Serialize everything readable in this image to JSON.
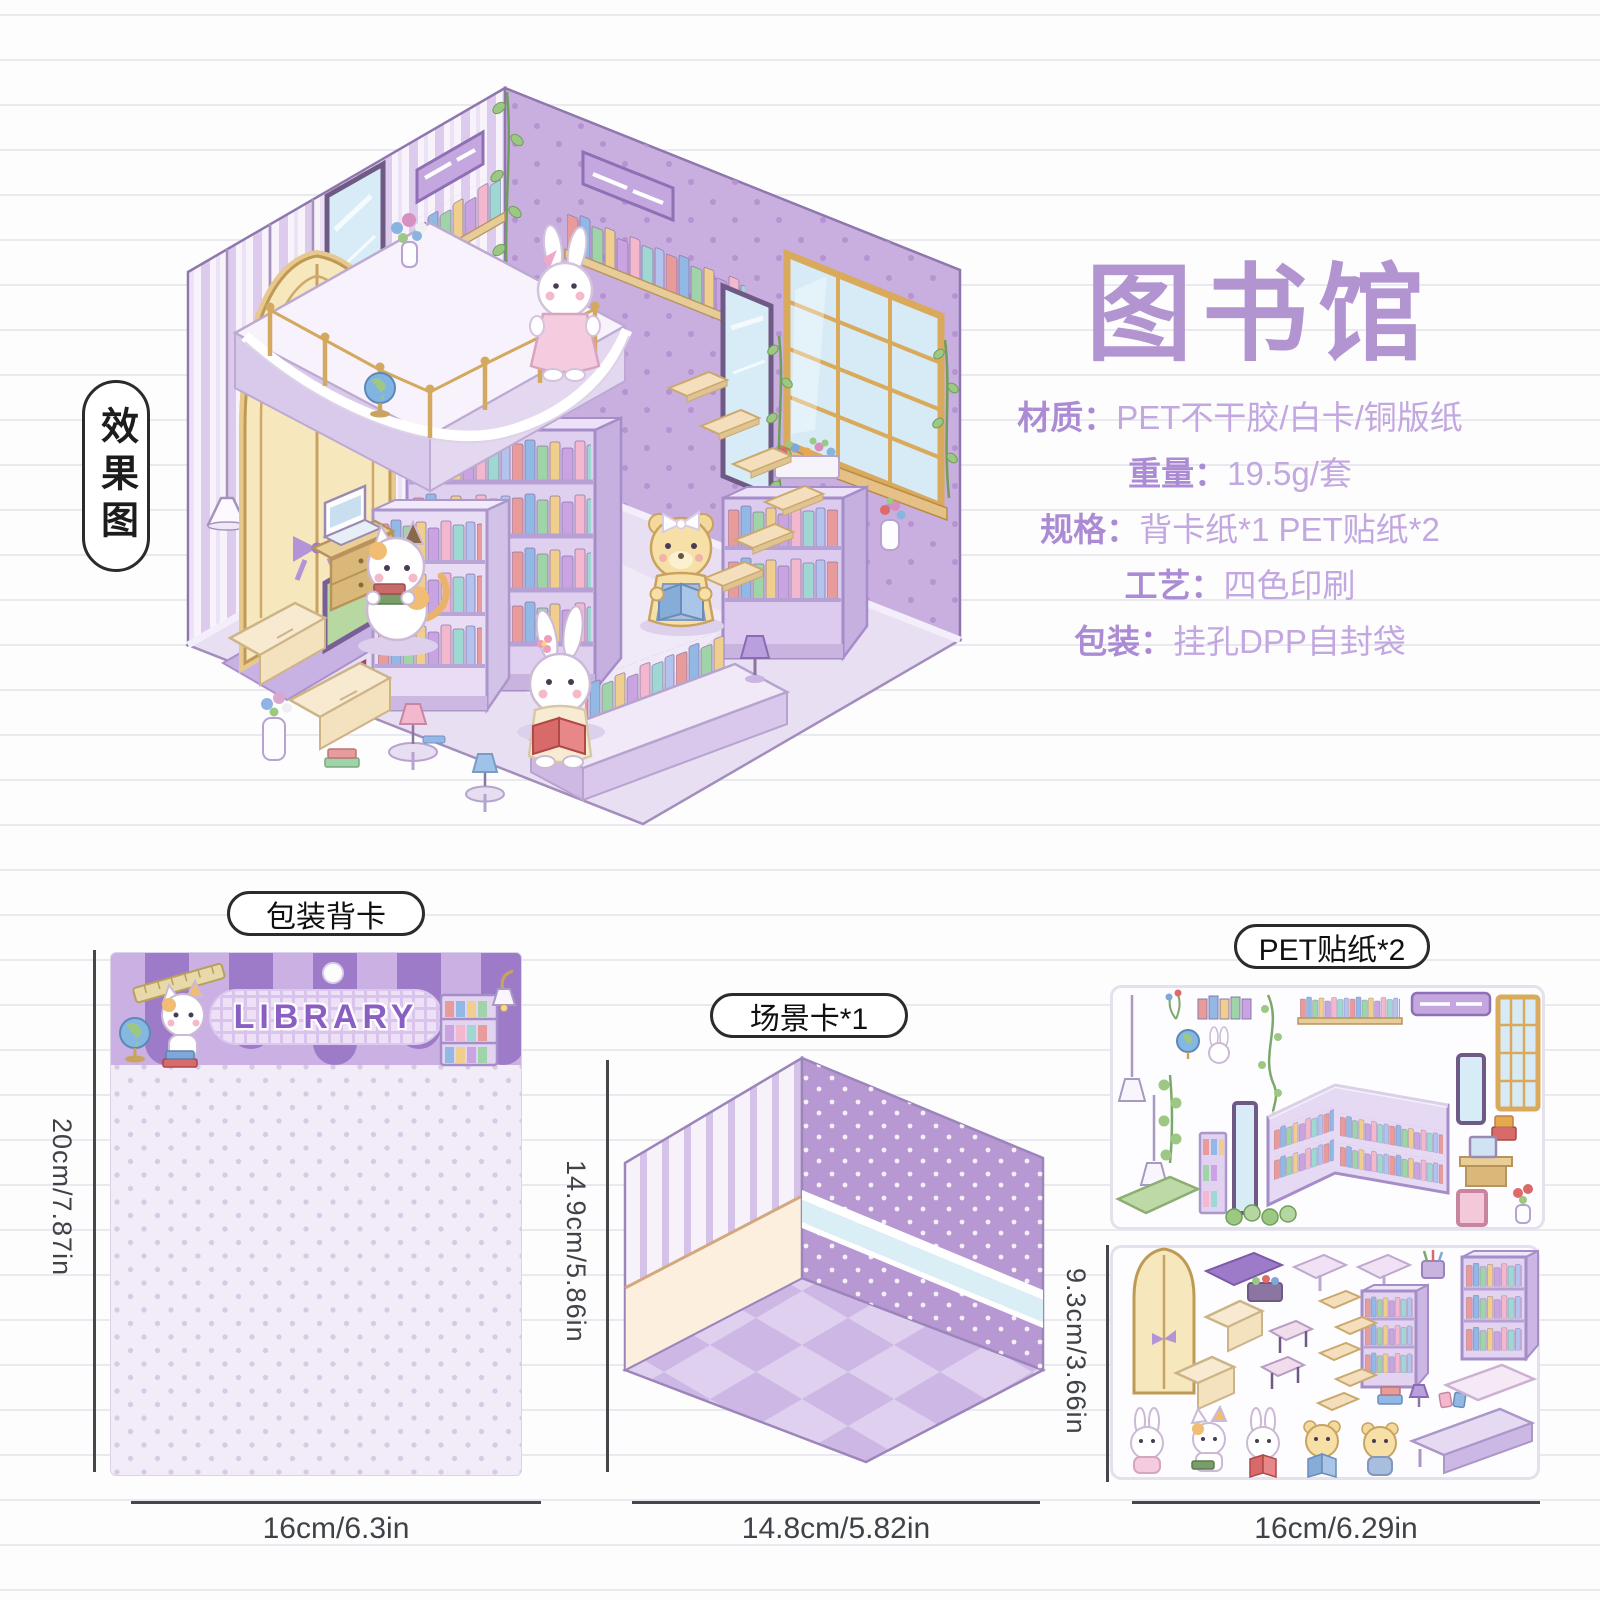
{
  "header": {
    "effect_label": "效果图"
  },
  "product": {
    "title": "图书馆",
    "specs": [
      {
        "label": "材质：",
        "value": "PET不干胶/白卡/铜版纸"
      },
      {
        "label": "重量：",
        "value": "19.5g/套"
      },
      {
        "label": "规格：",
        "value": "背卡纸*1 PET贴纸*2"
      },
      {
        "label": "工艺：",
        "value": "四色印刷"
      },
      {
        "label": "包装：",
        "value": "挂孔DPP自封袋"
      }
    ]
  },
  "components": {
    "back_card": {
      "label": "包装背卡",
      "banner": "LIBRARY",
      "height": "20cm/7.87in",
      "width": "16cm/6.3in"
    },
    "scene_card": {
      "label": "场景卡*1",
      "height": "14.9cm/5.86in",
      "width": "14.8cm/5.82in"
    },
    "sticker_sheets": {
      "label": "PET贴纸*2",
      "height": "9.3cm/3.66in",
      "width": "16cm/6.29in"
    }
  },
  "colors": {
    "accent_purple": "#b294d1",
    "spec_text": "#c2a7e0",
    "wall_purple": "#c9aee0",
    "stripe_purple": "#dbc9ec",
    "floor_purple": "#e9dff3",
    "cream": "#f7e7bc",
    "dim_text": "#3f4347",
    "banner_purple": "#8a5ec2"
  }
}
